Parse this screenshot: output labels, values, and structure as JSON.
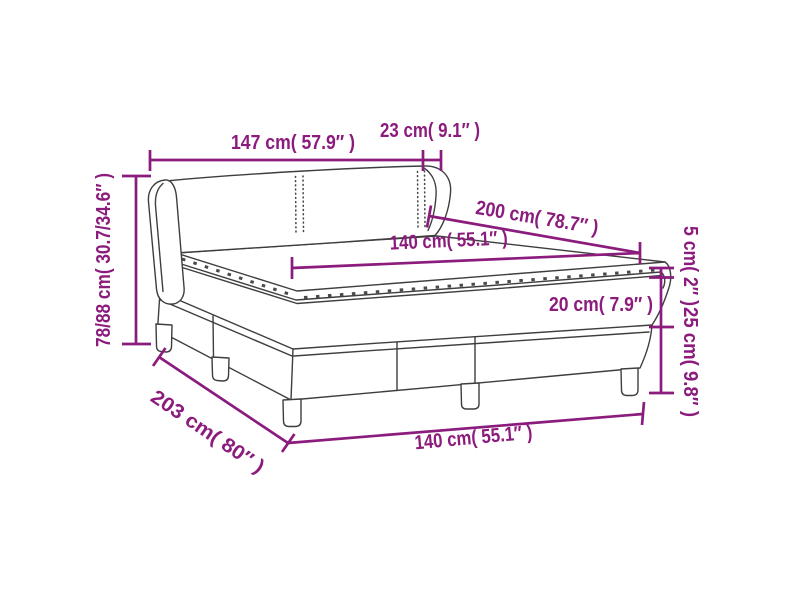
{
  "diagram": {
    "subject": "box-spring-bed-dimension-diagram",
    "colors": {
      "dimension_lines": "#8B1B7C",
      "drawing_lines": "#3E3E3E",
      "background": "#FFFFFF"
    },
    "dims": {
      "headboard_width": "147 cm( 57.9″ )",
      "headboard_depth": "23 cm( 9.1″ )",
      "height_range": "78/88 cm( 30.7/34.6″ )",
      "mattress_length": "200 cm( 78.7″ )",
      "mattress_width": "140 cm( 55.1″ )",
      "topper_height": "5 cm( 2″ )",
      "mattress_thickness": "20 cm( 7.9″ )",
      "base_height": "25 cm( 9.8″ )",
      "total_length": "203 cm( 80″ )",
      "base_width": "140 cm( 55.1″ )"
    }
  }
}
